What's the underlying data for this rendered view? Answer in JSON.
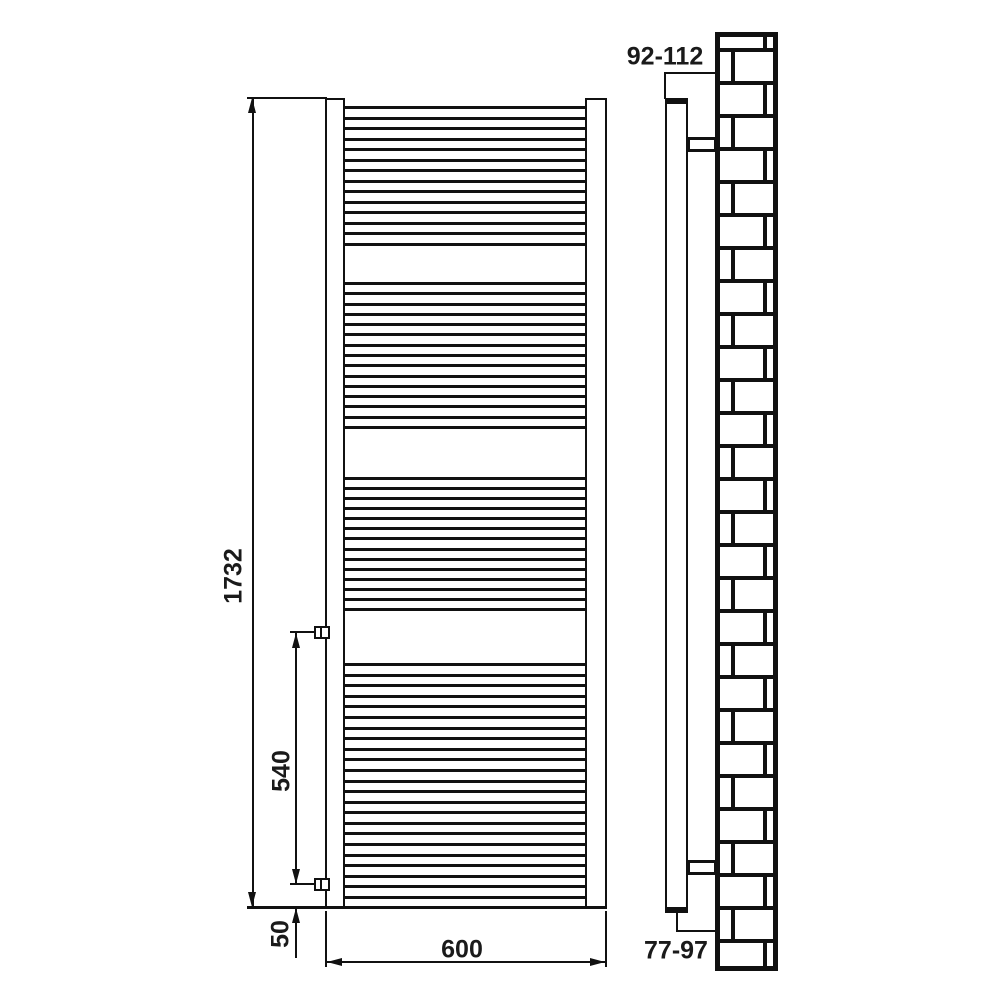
{
  "drawing": {
    "description": "towel radiator installation drawing, front and side elevation",
    "colors": {
      "line": "#111111",
      "background": "#ffffff"
    },
    "dimensions": {
      "height": "1732",
      "width": "600",
      "valve_spacing": "540",
      "valve_bottom_offset": "50",
      "wall_to_front_top": "92-112",
      "wall_to_valve_bottom": "77-97"
    },
    "front_view": {
      "tube_groups": [
        14,
        15,
        14,
        23
      ],
      "tube_thickness": 3
    },
    "side_view": {
      "brick_wall": {
        "rows": 29,
        "first_row_height": 18,
        "row_height": 33,
        "mortar_thickness": 4,
        "border_thickness": 5,
        "joint_offset_a": 48,
        "joint_offset_b": 16
      }
    }
  }
}
